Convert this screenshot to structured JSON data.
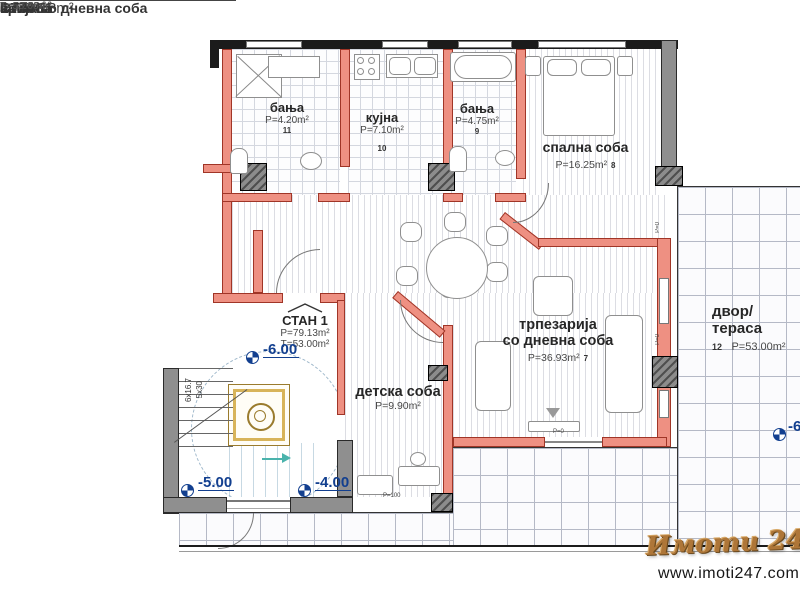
{
  "legend": {
    "rows": [
      {
        "label": "арија со дневна соба",
        "value": "P=36.93m²"
      },
      {
        "label": "на соба",
        "value": "P=16.25m²"
      },
      {
        "label": "а",
        "value": "P=4.75m²"
      },
      {
        "label": "а",
        "value": "P=7.10m²"
      },
      {
        "label": "а",
        "value": "P=4.20m²"
      },
      {
        "label": "ка соба",
        "value": "P=9.90m²"
      }
    ],
    "unit_label": "СТАН 1",
    "unit_value": "P=79.13m²",
    "terrace_label": "са",
    "terrace_value": "T=53.00m²"
  },
  "rooms": {
    "bath1": {
      "name": "бања",
      "area": "P=4.20m²",
      "num": "11"
    },
    "kitchen": {
      "name": "кујна",
      "area": "P=7.10m²",
      "num": "10"
    },
    "bath2": {
      "name": "бања",
      "area": "P=4.75m²",
      "num": "9"
    },
    "bedroom": {
      "name": "спална соба",
      "area": "P=16.25m²",
      "num": "8"
    },
    "living": {
      "line1": "трпезарија",
      "line2": "со дневна соба",
      "area": "P=36.93m²",
      "num": "7"
    },
    "kids": {
      "name": "детска соба",
      "area": "P=9.90m²"
    },
    "terrace": {
      "name": "двор/тераса",
      "num": "12",
      "area": "P=53.00m²"
    }
  },
  "unit_callout": {
    "name": "СТАН 1",
    "area": "P=79.13m²",
    "terrace_area": "T=53.00m²"
  },
  "elevations": {
    "lobby": "-6.00",
    "left": "-5.00",
    "right": "-4.00",
    "terrace": "-6"
  },
  "stairs": {
    "label1": "6x16.7",
    "label2": "5x30"
  },
  "small_labels": {
    "kids_door": "P=100",
    "wall_a": "P=0",
    "wall_b": "P=0",
    "terrace_door": "P=0"
  },
  "branding": {
    "logo": "Имоти 24/7",
    "url": "www.imoti247.com"
  },
  "colors": {
    "wall_red": "#EE9082",
    "wall_gray": "#8f8f8f",
    "marker_navy": "#123F8F",
    "logo_tan": "#AE7638"
  }
}
